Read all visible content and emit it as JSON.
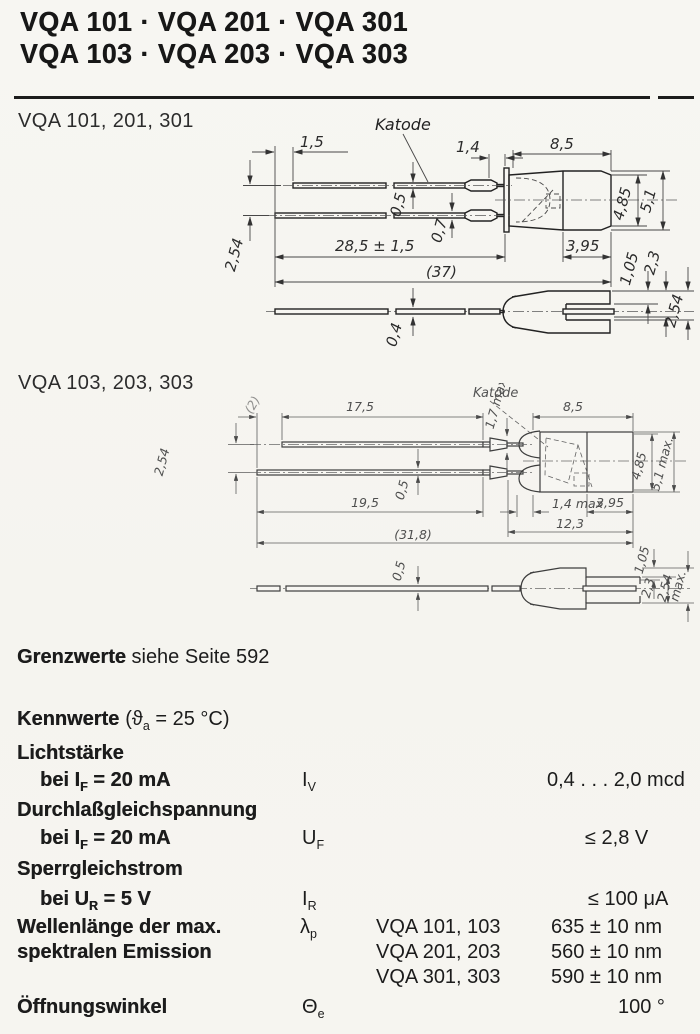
{
  "theme": {
    "paper": "#f7f6f2",
    "ink": "#1a1a1a"
  },
  "header": {
    "title_line1": "VQA 101 · VQA 201 · VQA 301",
    "title_line2": "VQA 103 · VQA 203 · VQA 303"
  },
  "drawing1": {
    "label": "VQA 101, 201, 301",
    "katode": "Katode",
    "dims": {
      "lead_offset": "1,5",
      "crimp_len": "1,4",
      "body_len": "8,5",
      "lead_top_th": "0,5",
      "lead_bot_th": "0,7",
      "lead_len": "28,5 ± 1,5",
      "total_len": "(37)",
      "body_h_inner": "4,85",
      "body_h_outer": "5,1",
      "rear_len": "3,95",
      "tip_step": "1,05",
      "slot_h": "2,3",
      "lead_pitch": "2,54",
      "wire_th": "0,4",
      "sleeve_h": "2,54"
    }
  },
  "drawing2": {
    "label": "VQA 103, 203, 303",
    "katode": "Katode",
    "dims": {
      "lead_offset": "(2)",
      "lead_top_len": "17,5",
      "crimp_h": "1,7 max",
      "body_len": "8,5",
      "lead_pitch": "2,54",
      "lead_bot_len": "19,5",
      "lead_th": "0,5",
      "tip_len": "1,4 max",
      "rear_len": "3,95",
      "head_len": "12,3",
      "total_len": "(31,8)",
      "body_h_inner": "4,85",
      "body_h_outer": "5,1 max.",
      "wire_th": "0,5",
      "tip_step": "1,05",
      "slot_h": "2,3",
      "sleeve_h": "2,54",
      "sleeve_h_suffix": "max."
    }
  },
  "limits_note": {
    "lead": "Grenzwerte",
    "rest": " siehe Seite 592"
  },
  "characteristics": {
    "heading": "Kennwerte",
    "cond_pre": "(ϑ",
    "cond_sub": "a",
    "cond_post": " = 25 °C)"
  },
  "specs": {
    "luminous": {
      "name": "Lichtstärke",
      "cond_pre": "bei I",
      "cond_sub": "F",
      "cond_post": " = 20 mA",
      "sym": "I",
      "sym_sub": "V",
      "value": "0,4 . . . 2,0 mcd"
    },
    "forward": {
      "name": "Durchlaßgleichspannung",
      "cond_pre": "bei I",
      "cond_sub": "F",
      "cond_post": " = 20 mA",
      "sym": "U",
      "sym_sub": "F",
      "value": "≤ 2,8 V"
    },
    "reverse": {
      "name": "Sperrgleichstrom",
      "cond_pre": "bei U",
      "cond_sub": "R",
      "cond_post": " = 5 V",
      "sym": "I",
      "sym_sub": "R",
      "value": "≤ 100 μA"
    },
    "wavelength": {
      "name_line1": "Wellenlänge der max.",
      "name_line2": "spektralen Emission",
      "sym": "λ",
      "sym_sub": "p",
      "entries": [
        {
          "variant": "VQA 101, 103",
          "value": "635 ± 10 nm"
        },
        {
          "variant": "VQA 201, 203",
          "value": "560 ± 10 nm"
        },
        {
          "variant": "VQA 301, 303",
          "value": "590 ± 10 nm"
        }
      ]
    },
    "aperture": {
      "name": "Öffnungswinkel",
      "sym": "Θ",
      "sym_sub": "e",
      "value": "100 °"
    }
  }
}
